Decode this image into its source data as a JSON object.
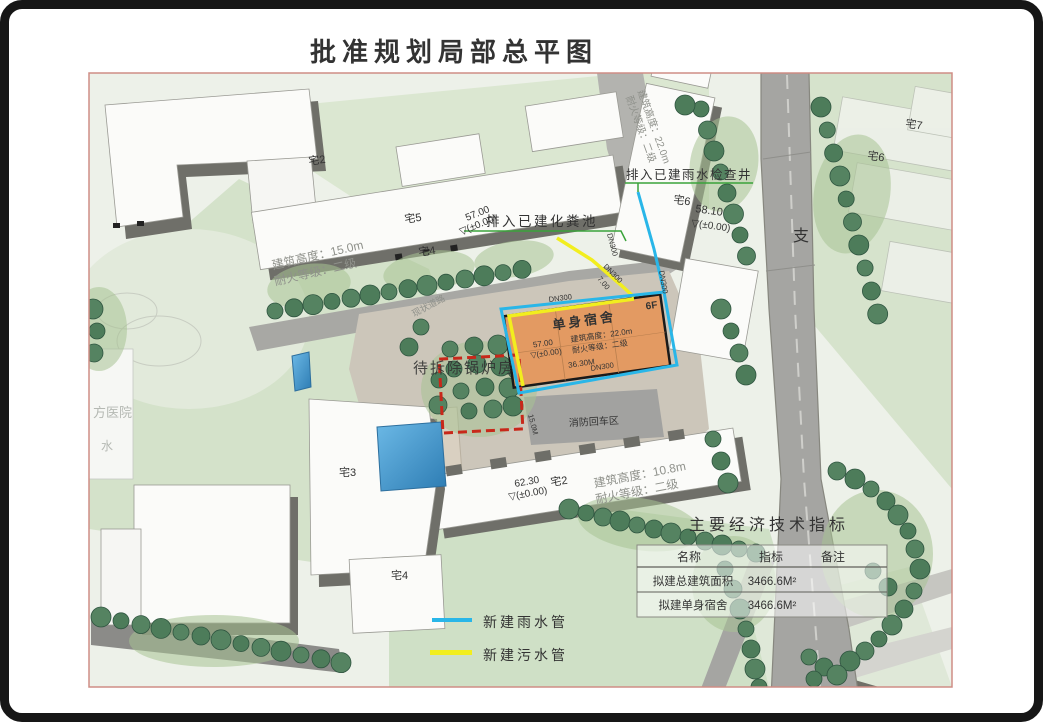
{
  "page": {
    "title": "批准规划局部总平图"
  },
  "legend": {
    "items": [
      {
        "label": "新建雨水管",
        "color": "#29b6e8"
      },
      {
        "label": "新建污水管",
        "color": "#f2ee1e"
      }
    ]
  },
  "table": {
    "title": "主要经济技术指标",
    "headers": [
      "名称",
      "指标",
      "备注"
    ],
    "rows": [
      {
        "name": "拟建总建筑面积",
        "value": "3466.6M²",
        "note": ""
      },
      {
        "name": "拟建单身宿舍",
        "value": "3466.6M²",
        "note": ""
      }
    ]
  },
  "dorm": {
    "name": "单身宿舍",
    "floors": "6F",
    "height": "建筑高度：22.0m",
    "fire": "耐火等级：二级",
    "elev": "57.00",
    "elev_zero": "▽(±0.00)",
    "length": "36.30M"
  },
  "buildings": {
    "b15": {
      "height": "建筑高度：15.0m",
      "fire": "耐火等级：二级"
    },
    "b10": {
      "height": "建筑高度：10.8m",
      "fire": "耐火等级：二级"
    },
    "b22": {
      "height": "建筑高度：22.0m",
      "fire": "耐火等级：二级"
    }
  },
  "elevations": {
    "e1": "58.10",
    "e2": "57.00",
    "e3": "62.30",
    "zero": "▽(±0.00)"
  },
  "annotations": {
    "rain_label": "排入已建雨水检查井",
    "septic_label": "排入已建化粪池",
    "boiler_label": "待拆除锅炉房",
    "fire_turnaround": "消防回车区",
    "existing_road": "现状道路",
    "branch_road": "支",
    "hospital": "方医院",
    "water": "水",
    "dn_label": "DN300",
    "dim_15m": "15.0M",
    "dim_7": "7.00"
  },
  "houses": {
    "z2": "宅2",
    "z3": "宅3",
    "z4": "宅4",
    "z5": "宅5",
    "z6": "宅6",
    "z7": "宅7"
  },
  "colors": {
    "rain_pipe": "#29b6e8",
    "sewage_pipe": "#f2ee1e",
    "dorm_fill": "#e39a62",
    "demolish_red": "#c8281a",
    "tree_green": "#4d7c5a",
    "frame_pink": "#cf8d85"
  }
}
